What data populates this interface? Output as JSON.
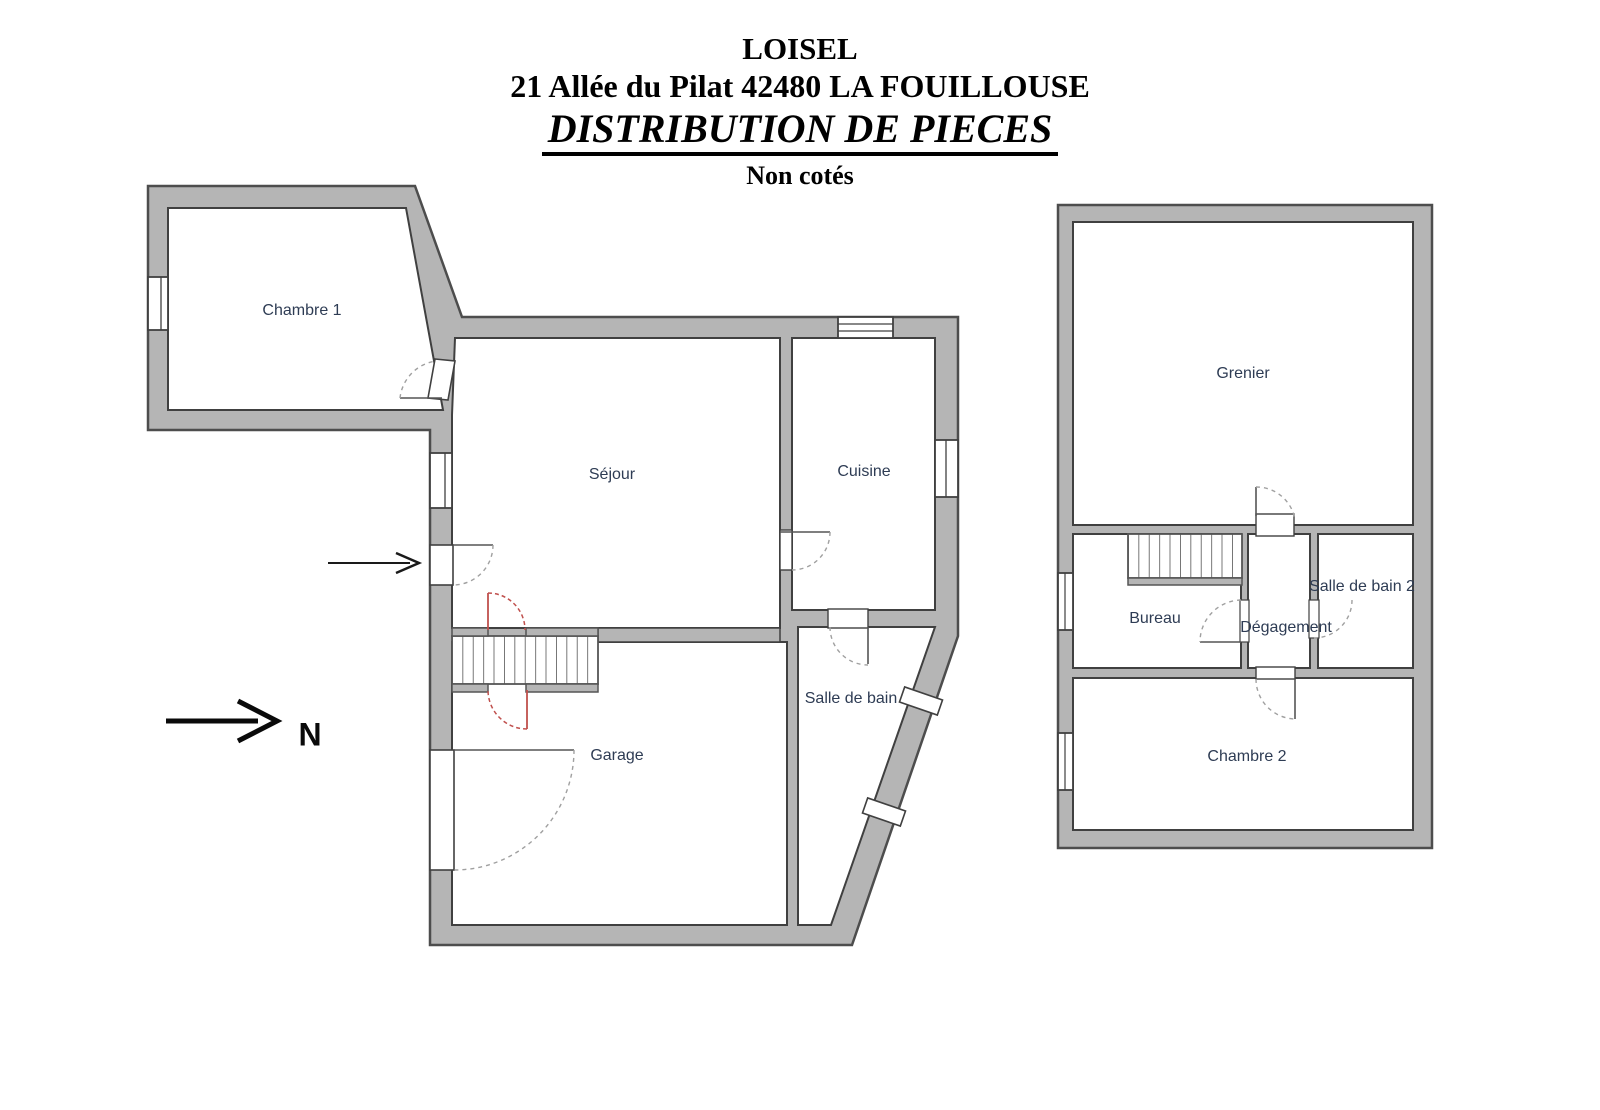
{
  "header": {
    "name": "LOISEL",
    "address": "21 Allée du Pilat 42480 LA FOUILLOUSE",
    "title": "DISTRIBUTION DE PIECES",
    "subtitle": "Non cotés"
  },
  "compass": {
    "label": "N"
  },
  "floors": {
    "ground": {
      "rooms": [
        {
          "label": "Chambre 1"
        },
        {
          "label": "Séjour"
        },
        {
          "label": "Cuisine"
        },
        {
          "label": "Salle de bain"
        },
        {
          "label": "Garage"
        }
      ]
    },
    "upper": {
      "rooms": [
        {
          "label": "Grenier"
        },
        {
          "label": "Bureau"
        },
        {
          "label": "Dégagement"
        },
        {
          "label": "Salle de bain 2"
        },
        {
          "label": "Chambre 2"
        }
      ]
    }
  },
  "colors": {
    "wall_fill": "#b5b5b5",
    "wall_outline": "#4d4d4d",
    "door_arc": "#a0a0a0",
    "door_accent_red": "#c0504d",
    "room_label": "#2e3c54"
  }
}
